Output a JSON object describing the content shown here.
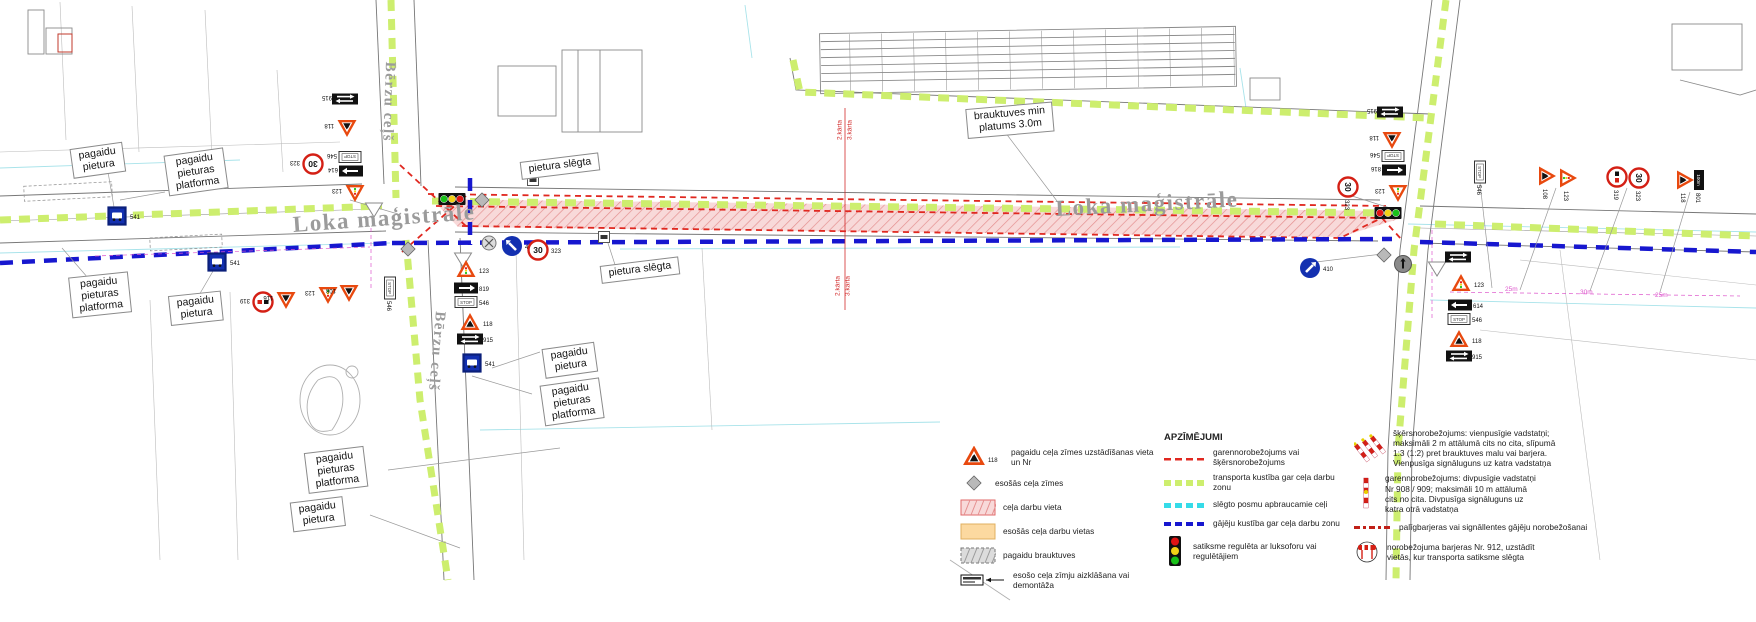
{
  "canvas": {
    "width": 1756,
    "height": 622
  },
  "speed_text": "30",
  "stop_text": "STOP",
  "plate_801_text": "100m",
  "road_labels": [
    {
      "text": "Loka maģistrāle",
      "x": 292,
      "y": 212,
      "rot": -4,
      "size": 23
    },
    {
      "text": "Loka maģistrāle",
      "x": 1055,
      "y": 196,
      "rot": -3,
      "size": 23
    },
    {
      "text": "Bērzu ceļš",
      "x": 398,
      "y": 62,
      "rot": 92,
      "size": 15
    },
    {
      "text": "Bērzu ceļš",
      "x": 448,
      "y": 312,
      "rot": 95,
      "size": 15
    }
  ],
  "note_labels": [
    {
      "text": "pagaidu\npietura",
      "x": 98,
      "y": 160,
      "rot": -8
    },
    {
      "text": "pagaidu\npieturas\nplatforma",
      "x": 196,
      "y": 172,
      "rot": -8
    },
    {
      "text": "pagaidu\npieturas\nplatforma",
      "x": 100,
      "y": 295,
      "rot": -6
    },
    {
      "text": "pagaidu\npietura",
      "x": 196,
      "y": 308,
      "rot": -6
    },
    {
      "text": "pietura slēgta",
      "x": 560,
      "y": 166,
      "rot": -7
    },
    {
      "text": "pietura slēgta",
      "x": 640,
      "y": 270,
      "rot": -7
    },
    {
      "text": "brauktuves min\nplatums 3.0m",
      "x": 1010,
      "y": 120,
      "rot": -5
    },
    {
      "text": "pagaidu\npietura",
      "x": 570,
      "y": 360,
      "rot": -8
    },
    {
      "text": "pagaidu\npieturas\nplatforma",
      "x": 572,
      "y": 402,
      "rot": -8
    },
    {
      "text": "pagaidu\npieturas\nplatforma",
      "x": 336,
      "y": 470,
      "rot": -7
    },
    {
      "text": "pagaidu\npietura",
      "x": 318,
      "y": 514,
      "rot": -7
    }
  ],
  "stage_labels": [
    {
      "text": "2.kārta",
      "x": 840,
      "y": 130,
      "rot": -90
    },
    {
      "text": "3.kārta",
      "x": 850,
      "y": 130,
      "rot": -90
    },
    {
      "text": "2.kārta",
      "x": 838,
      "y": 286,
      "rot": -90
    },
    {
      "text": "3.kārta",
      "x": 848,
      "y": 286,
      "rot": -90
    }
  ],
  "dim_labels": [
    {
      "text": "25m",
      "x": 1505,
      "y": 286
    },
    {
      "text": "30m",
      "x": 1580,
      "y": 289
    },
    {
      "text": "25m",
      "x": 1655,
      "y": 292
    }
  ],
  "signs": [
    {
      "type": "plate-double-arrow",
      "x": 345,
      "y": 99,
      "rot": 180,
      "num": "915"
    },
    {
      "type": "tri-worker",
      "x": 347,
      "y": 127,
      "rot": 180,
      "num": "118"
    },
    {
      "type": "plate-stop",
      "x": 350,
      "y": 157,
      "rot": 180,
      "num": "546"
    },
    {
      "type": "plate-arrow",
      "x": 351,
      "y": 171,
      "rot": 180,
      "num": "614",
      "dir": "right"
    },
    {
      "type": "tri-light",
      "x": 355,
      "y": 192,
      "rot": 180,
      "num": "123"
    },
    {
      "type": "circle-30",
      "x": 313,
      "y": 164,
      "rot": 180,
      "num": "323"
    },
    {
      "type": "tri-yield-white",
      "x": 374,
      "y": 209,
      "rot": 0
    },
    {
      "type": "traffic-light",
      "x": 452,
      "y": 199,
      "rot": 0,
      "lights": "gyr"
    },
    {
      "type": "diamond",
      "x": 482,
      "y": 200,
      "rot": 0
    },
    {
      "type": "diamond",
      "x": 408,
      "y": 249,
      "rot": 0
    },
    {
      "type": "circle-crossed",
      "x": 489,
      "y": 243,
      "rot": 0
    },
    {
      "type": "blue-arrow",
      "x": 512,
      "y": 246,
      "rot": 0,
      "num": "411",
      "dir": "nw"
    },
    {
      "type": "circle-30",
      "x": 538,
      "y": 250,
      "rot": 0,
      "num": "323"
    },
    {
      "type": "tri-yield-white",
      "x": 463,
      "y": 259,
      "rot": 0
    },
    {
      "type": "tri-light",
      "x": 466,
      "y": 270,
      "rot": 0,
      "num": "123"
    },
    {
      "type": "plate-arrow",
      "x": 466,
      "y": 288,
      "rot": 0,
      "num": "819",
      "dir": "right"
    },
    {
      "type": "plate-stop",
      "x": 466,
      "y": 302,
      "rot": 0,
      "num": "546"
    },
    {
      "type": "tri-worker",
      "x": 470,
      "y": 323,
      "rot": 0,
      "num": "118"
    },
    {
      "type": "plate-double-arrow",
      "x": 470,
      "y": 339,
      "rot": 0,
      "num": "915"
    },
    {
      "type": "sign-bus",
      "x": 472,
      "y": 363,
      "rot": 0,
      "num": "541"
    },
    {
      "type": "plate-stop",
      "x": 390,
      "y": 288,
      "rot": 90,
      "num": "546"
    },
    {
      "type": "circle-ban",
      "x": 263,
      "y": 302,
      "rot": 180,
      "num": "319"
    },
    {
      "type": "tri-worker",
      "x": 286,
      "y": 299,
      "rot": 180,
      "num": "116"
    },
    {
      "type": "tri-light",
      "x": 328,
      "y": 294,
      "rot": 180,
      "num": "123"
    },
    {
      "type": "tri-worker",
      "x": 349,
      "y": 292,
      "rot": 180,
      "num": "108"
    },
    {
      "type": "sign-bus",
      "x": 117,
      "y": 216,
      "rot": 0,
      "num": "541"
    },
    {
      "type": "sign-bus",
      "x": 217,
      "y": 262,
      "rot": 0,
      "num": "541"
    },
    {
      "type": "bus-marker",
      "x": 533,
      "y": 180,
      "rot": 0
    },
    {
      "type": "bus-marker",
      "x": 604,
      "y": 237,
      "rot": 0
    },
    {
      "type": "plate-double-arrow",
      "x": 1390,
      "y": 112,
      "rot": 180,
      "num": "915"
    },
    {
      "type": "tri-worker",
      "x": 1392,
      "y": 139,
      "rot": 180,
      "num": "118"
    },
    {
      "type": "plate-stop",
      "x": 1393,
      "y": 156,
      "rot": 180,
      "num": "546"
    },
    {
      "type": "plate-arrow",
      "x": 1394,
      "y": 170,
      "rot": 180,
      "num": "816",
      "dir": "left"
    },
    {
      "type": "tri-light",
      "x": 1398,
      "y": 192,
      "rot": 180,
      "num": "123"
    },
    {
      "type": "circle-30",
      "x": 1348,
      "y": 187,
      "rot": 90,
      "num": "323"
    },
    {
      "type": "traffic-light",
      "x": 1388,
      "y": 213,
      "rot": 0,
      "lights": "ryg"
    },
    {
      "type": "diamond",
      "x": 1384,
      "y": 255,
      "rot": 0
    },
    {
      "type": "circle-gray-arrow",
      "x": 1403,
      "y": 264,
      "rot": 0
    },
    {
      "type": "tri-yield-white",
      "x": 1437,
      "y": 268,
      "rot": 0
    },
    {
      "type": "plate-double-arrow",
      "x": 1458,
      "y": 257,
      "rot": 0
    },
    {
      "type": "blue-arrow",
      "x": 1310,
      "y": 268,
      "rot": 0,
      "num": "410",
      "dir": "ne"
    },
    {
      "type": "tri-light",
      "x": 1461,
      "y": 284,
      "rot": 0,
      "num": "123"
    },
    {
      "type": "plate-arrow",
      "x": 1460,
      "y": 305,
      "rot": 0,
      "num": "614",
      "dir": "left"
    },
    {
      "type": "plate-stop",
      "x": 1459,
      "y": 319,
      "rot": 0,
      "num": "546"
    },
    {
      "type": "tri-worker",
      "x": 1459,
      "y": 340,
      "rot": 0,
      "num": "118"
    },
    {
      "type": "plate-double-arrow",
      "x": 1459,
      "y": 356,
      "rot": 0,
      "num": "915"
    },
    {
      "type": "plate-stop",
      "x": 1480,
      "y": 172,
      "rot": 90,
      "num": "546"
    },
    {
      "type": "tri-worker",
      "x": 1546,
      "y": 176,
      "rot": 90,
      "num": "108"
    },
    {
      "type": "tri-light",
      "x": 1567,
      "y": 178,
      "rot": 90,
      "num": "123"
    },
    {
      "type": "circle-ban",
      "x": 1617,
      "y": 177,
      "rot": 90,
      "num": "319"
    },
    {
      "type": "circle-30",
      "x": 1639,
      "y": 178,
      "rot": 90,
      "num": "323"
    },
    {
      "type": "tri-worker",
      "x": 1684,
      "y": 180,
      "rot": 90,
      "num": "118"
    },
    {
      "type": "plate-100m",
      "x": 1699,
      "y": 180,
      "rot": 90,
      "num": "801"
    }
  ],
  "legend": {
    "title": "APZĪMĒJUMI",
    "col1": [
      {
        "icon": "lg-tri",
        "num": "118",
        "text": "pagaidu ceļa zīmes uzstādīšanas vieta un Nr"
      },
      {
        "icon": "lg-diamond",
        "text": "esošās ceļa zīmes"
      },
      {
        "icon": "lg-area-red",
        "text": "ceļa darbu vieta"
      },
      {
        "icon": "lg-area-orange",
        "text": "esošās ceļa darbu vietas"
      },
      {
        "icon": "lg-area-gray",
        "text": "pagaidu brauktuves"
      },
      {
        "icon": "lg-covered",
        "text": "esošo ceļa zīmju aizklāšana vai demontāža"
      }
    ],
    "col2": [
      {
        "icon": "lg-dash-red",
        "text": "garennorobežojums vai šķērsnorobežojums"
      },
      {
        "icon": "lg-dash-green",
        "text": "transporta kustība gar ceļa darbu zonu"
      },
      {
        "icon": "lg-dash-cyan",
        "text": "slēgto posmu apbraucamie ceļi"
      },
      {
        "icon": "lg-dash-blue",
        "text": "gājēju kustība gar ceļa darbu zonu"
      },
      {
        "icon": "lg-tl",
        "text": "satiksme regulēta ar luksoforu vai\nregulētājiem"
      }
    ],
    "col3": [
      {
        "icon": "lg-posts-angled",
        "text": "šķērsnorobežojums: vienpusīgie vadstatņi;\nmaksimāli 2 m attālumā cits no cita, slīpumā\n1:3 (1:2) pret brauktuves malu vai barjera.\nVienpusīga signāluguns uz katra vadstatņa"
      },
      {
        "icon": "lg-post-vert",
        "text": "garennorobežojums: divpusīgie vadstatņi\nNr 908 / 909; maksimāli 10 m attālumā\ncits no cita. Divpusīga signāluguns uz\nkatra otrā vadstatņa"
      },
      {
        "icon": "lg-barrier-dash",
        "text": "palīgbarjeras vai signāllentes gājēju norobežošanai"
      },
      {
        "icon": "lg-barrier-912",
        "text": "norobežojuma barjeras Nr. 912, uzstādīt\nvietās, kur transporta satiksme slēgta"
      }
    ]
  }
}
